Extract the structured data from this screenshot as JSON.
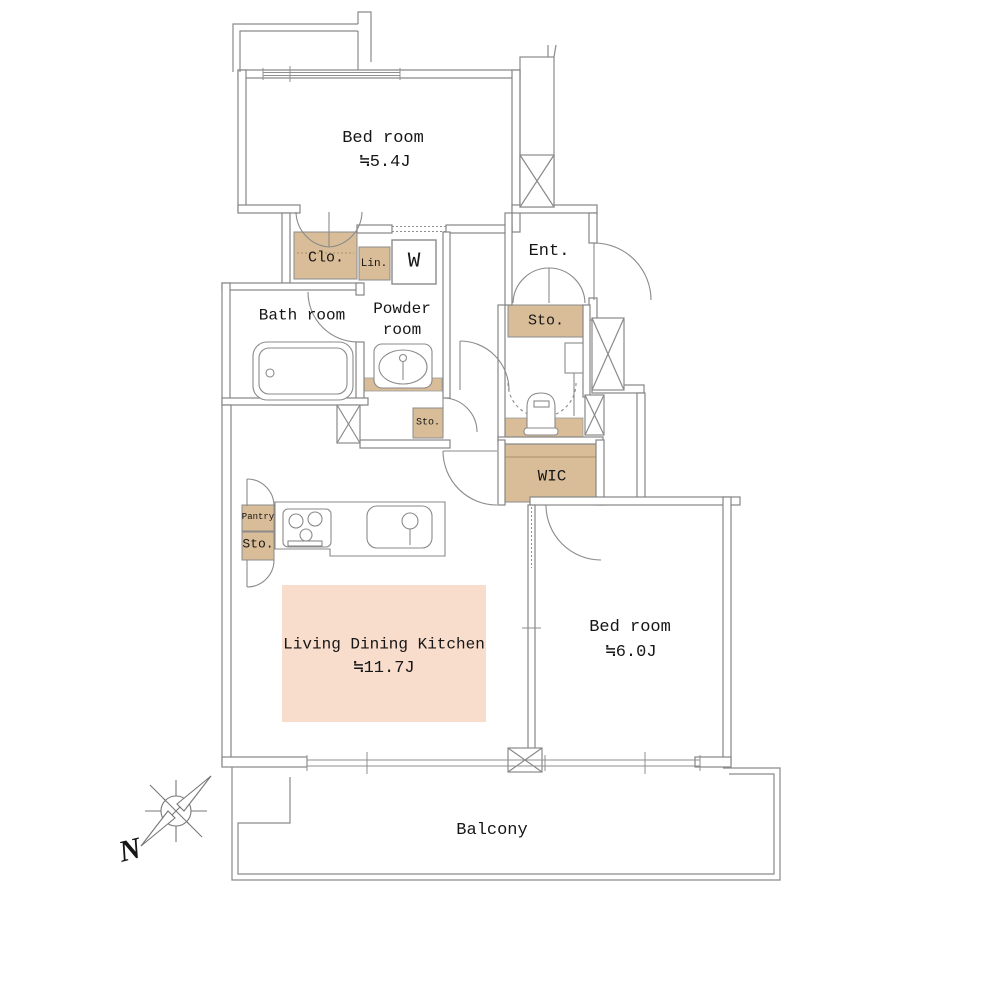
{
  "rooms": {
    "bedroom1": {
      "name": "Bed room",
      "area": "≒5.4J"
    },
    "bedroom2": {
      "name": "Bed room",
      "area": "≒6.0J"
    },
    "ldk": {
      "name": "Living Dining Kitchen",
      "area": "≒11.7J"
    },
    "bathroom": {
      "name": "Bath room"
    },
    "powder_room": {
      "name": "Powder room"
    },
    "entrance": {
      "name": "Ent."
    },
    "wic": {
      "name": "WIC"
    },
    "balcony": {
      "name": "Balcony"
    },
    "closet": {
      "name": "Clo."
    },
    "linen": {
      "name": "Lin."
    },
    "washer": {
      "name": "W"
    },
    "pantry": {
      "name": "Pantry"
    },
    "storage_entrance": {
      "name": "Sto."
    },
    "storage_powder": {
      "name": "Sto."
    },
    "storage_kitchen": {
      "name": "Sto."
    }
  },
  "compass": {
    "north": "N"
  },
  "colors": {
    "storage_fill": "#d9bd98",
    "ldk_highlight": "#f8dccc",
    "wall_line": "#858585",
    "text": "#161616"
  }
}
